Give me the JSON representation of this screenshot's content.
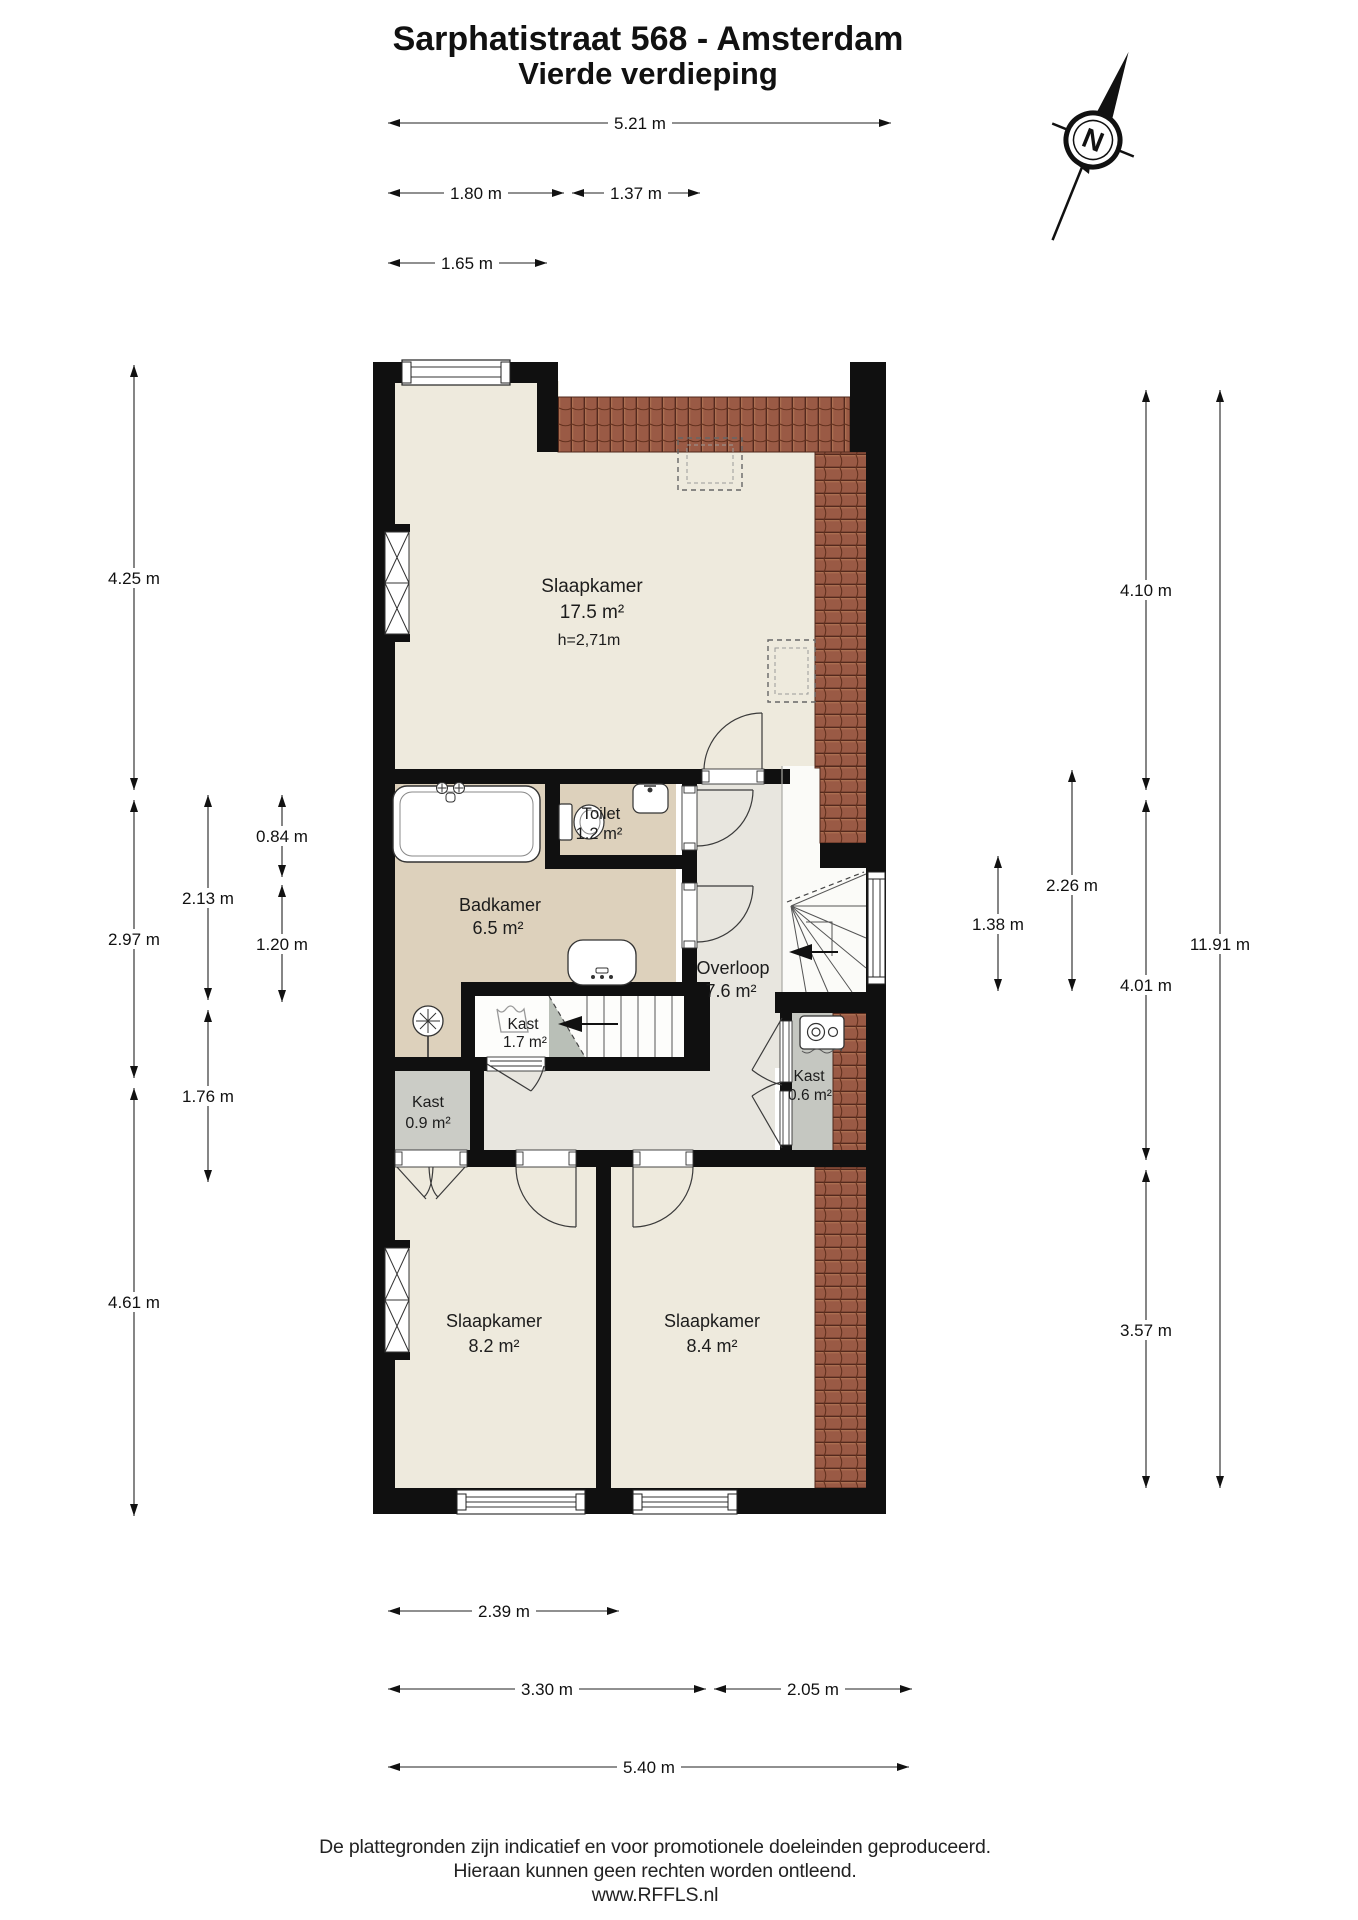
{
  "title": {
    "line1": "Sarphatistraat 568 - Amsterdam",
    "line2": "Vierde verdieping"
  },
  "compass": {
    "label": "N",
    "direction": "north-up-right"
  },
  "rooms": {
    "slaapkamer_boven": {
      "label": "Slaapkamer",
      "area": "17.5 m²",
      "ceiling_height": "h=2,71m"
    },
    "toilet": {
      "label": "Toilet",
      "area": "1.2 m²"
    },
    "badkamer": {
      "label": "Badkamer",
      "area": "6.5 m²"
    },
    "overloop": {
      "label": "Overloop",
      "area": "7.6 m²"
    },
    "kast_bij_trap": {
      "label": "Kast",
      "area": "1.7 m²"
    },
    "kast_links": {
      "label": "Kast",
      "area": "0.9 m²"
    },
    "kast_cv": {
      "label": "Kast",
      "area": "0.6 m²"
    },
    "slaapkamer_linksonder": {
      "label": "Slaapkamer",
      "area": "8.2 m²"
    },
    "slaapkamer_rechtsonder": {
      "label": "Slaapkamer",
      "area": "8.4 m²"
    }
  },
  "dimensions": {
    "top_total": "5.21 m",
    "top_left": "1.80 m",
    "top_mid": "1.37 m",
    "top_step": "1.65 m",
    "left_top": "4.25 m",
    "left_mid": "2.97 m",
    "left_bottom": "4.61 m",
    "left_inner_top": "2.13 m",
    "left_inner_bottom": "1.76 m",
    "left_inner2_top": "0.84 m",
    "left_inner2_bottom": "1.20 m",
    "right_stair": "1.38 m",
    "right_stairwell": "2.26 m",
    "right_top": "4.10 m",
    "right_mid": "4.01 m",
    "right_bottom": "3.57 m",
    "right_total": "11.91 m",
    "bottom_room_left": "2.39 m",
    "bottom_left": "3.30 m",
    "bottom_right": "2.05 m",
    "bottom_total": "5.40 m"
  },
  "footer": {
    "line1": "De plattegronden zijn indicatief en voor promotionele doeleinden geproduceerd.",
    "line2": "Hieraan kunnen geen rechten worden ontleend.",
    "line3": "www.RFFLS.nl"
  },
  "colors": {
    "wall": "#101010",
    "roof_tiles": "#9a5a45",
    "floor_room": "#eeeadd",
    "floor_bathroom": "#ddd1bc",
    "floor_hall": "#e8e6df",
    "floor_closet": "#cbccc6",
    "understair_wedge": "#b9bfb7"
  }
}
